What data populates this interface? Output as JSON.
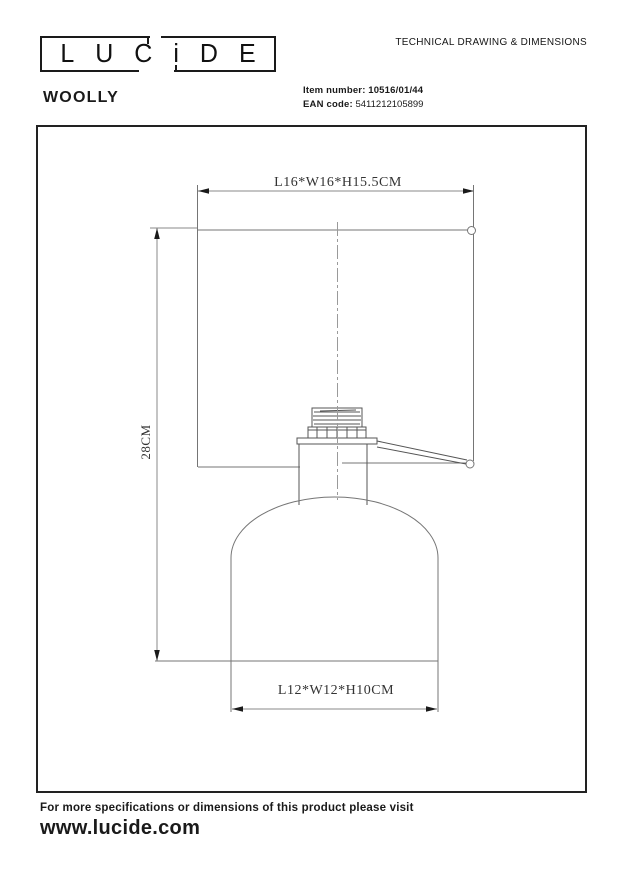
{
  "header": {
    "logo_letters": [
      "L",
      "U",
      "C",
      "i",
      "D",
      "E"
    ],
    "doc_title": "TECHNICAL DRAWING & DIMENSIONS",
    "product_name": "WOOLLY",
    "item_number_label": "Item number:",
    "item_number_value": "10516/01/44",
    "ean_label": "EAN code:",
    "ean_value": "5411212105899"
  },
  "drawing": {
    "dim_shade": "L16*W16*H15.5CM",
    "dim_total_height": "28CM",
    "dim_base": "L12*W12*H10CM"
  },
  "footer": {
    "note": "For more specifications or dimensions of this product please visit",
    "website": "www.lucide.com"
  },
  "colors": {
    "ink": "#1a1a1a",
    "outline_line": "#757575",
    "dimension_line": "#8a8a8a",
    "center_line": "#9a9a9a",
    "background": "#ffffff"
  }
}
